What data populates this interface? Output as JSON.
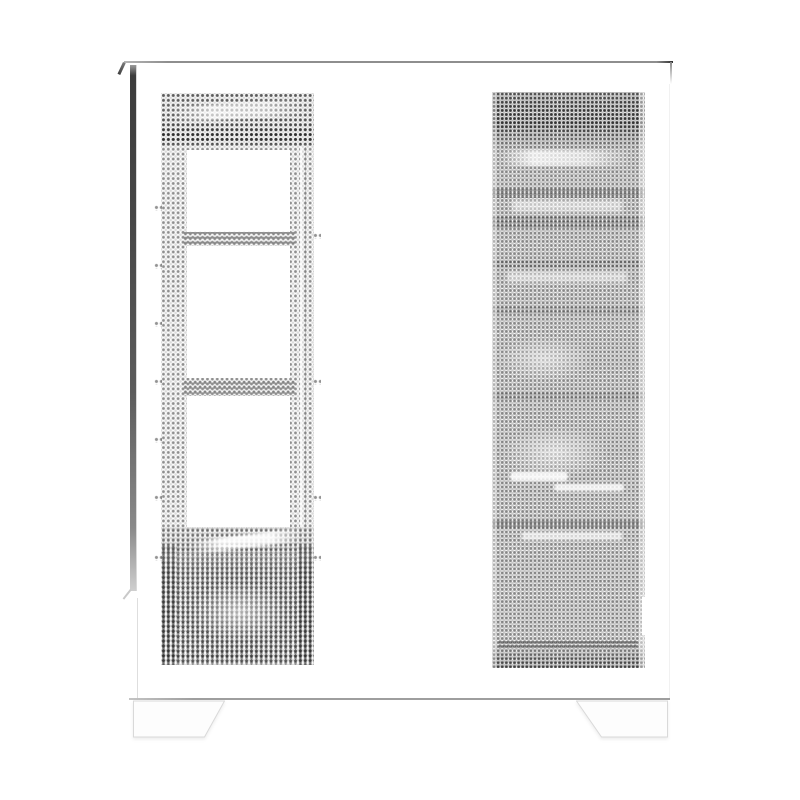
{
  "scene": {
    "label": "White mid-tower PC case, side product view on white background",
    "object": "pc-case",
    "finish": "white",
    "background_color": "#ffffff",
    "left_panel": {
      "type": "perforated-mesh-side-panel",
      "fan_cutouts": 3,
      "psu_vent_block": true,
      "mesh_dot_color": "#2e2e2e"
    },
    "right_panel": {
      "type": "perforated-mesh-panel",
      "internals_silhouette_visible": true,
      "mesh_dot_color": "#232323"
    },
    "feet_count": 2,
    "palette": {
      "body": "#ffffff",
      "top_edge_line": "#8e8e8e",
      "left_edge_shadow": "#474747",
      "bottom_edge_line": "#9e9e9e",
      "foot_fill": "#fdfdfd",
      "foot_outline": "#d9d9d9"
    }
  }
}
